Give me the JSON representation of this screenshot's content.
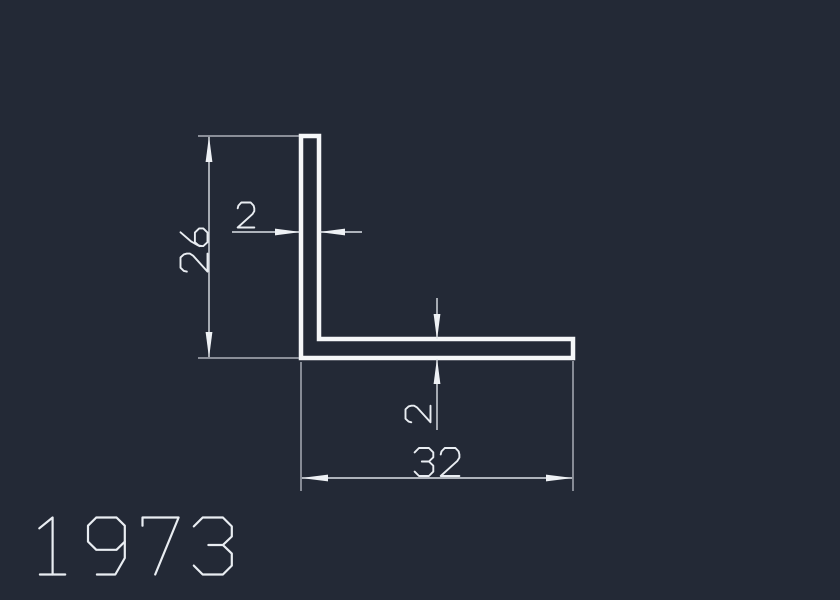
{
  "canvas": {
    "background_color": "#232936",
    "line_color": "#f5f7f9",
    "dim_color": "#dde1e7"
  },
  "title_block": {
    "part_number": "1973"
  },
  "drawing": {
    "kind": "cad-cross-section",
    "shape": "L-angle-profile",
    "profile": {
      "leg_height": 26,
      "leg_width": 32,
      "thickness": 2
    },
    "dimensions": [
      {
        "id": "leg-height",
        "value": "26",
        "orientation": "vertical"
      },
      {
        "id": "web-thickness",
        "value": "2",
        "orientation": "horizontal"
      },
      {
        "id": "flange-thickness",
        "value": "2",
        "orientation": "vertical"
      },
      {
        "id": "leg-width",
        "value": "32",
        "orientation": "horizontal"
      }
    ]
  }
}
